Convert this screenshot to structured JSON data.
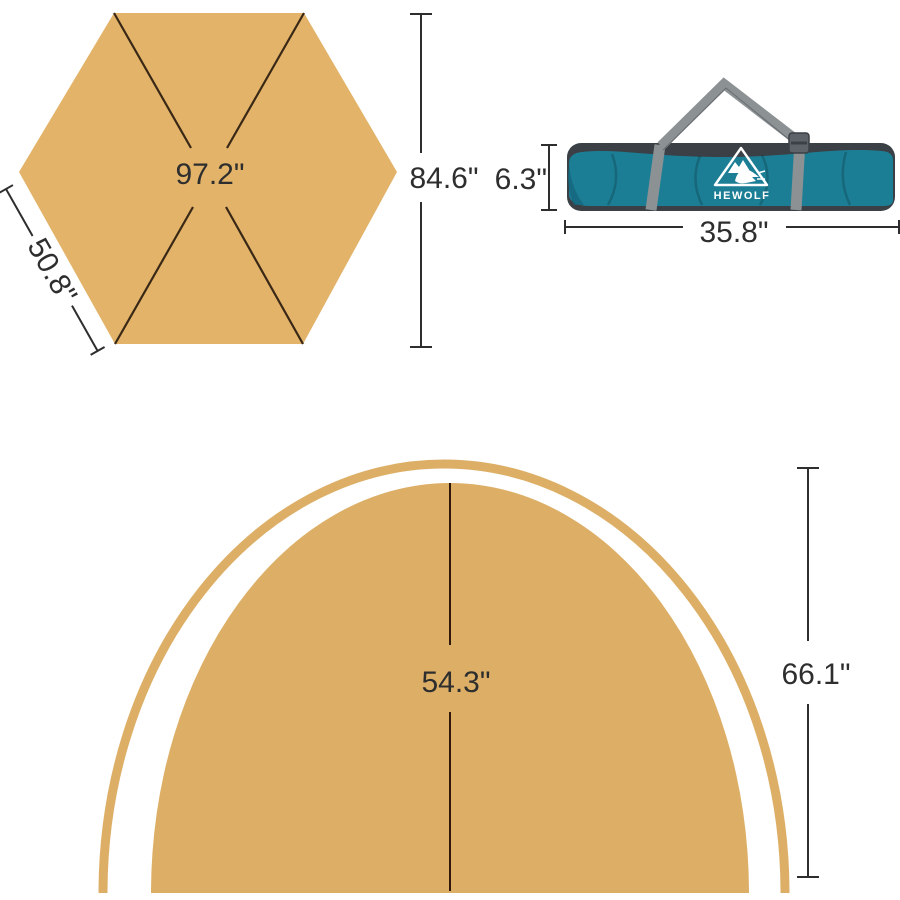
{
  "figure": {
    "hexagon": {
      "width_label": "97.2\"",
      "height_label": "84.6\"",
      "side_label": "50.8\""
    },
    "bag": {
      "brand": "HEWOLF",
      "height_label": "6.3\"",
      "width_label": "35.8\""
    },
    "dome": {
      "radius_label": "54.3\"",
      "height_label": "66.1\""
    }
  },
  "colors": {
    "canvas": "#ffffff",
    "tan": "#e2b368",
    "tan_dome": "#ddaf66",
    "ink": "#2e2e2e",
    "inner_line": "#3a2817",
    "dome_line": "#33190c",
    "bag_teal": "#1c7e95",
    "bag_teal_dark": "#14657c",
    "bag_dark": "#3a4045",
    "strap_gray": "#8c9194",
    "logo_white": "#ffffff"
  }
}
